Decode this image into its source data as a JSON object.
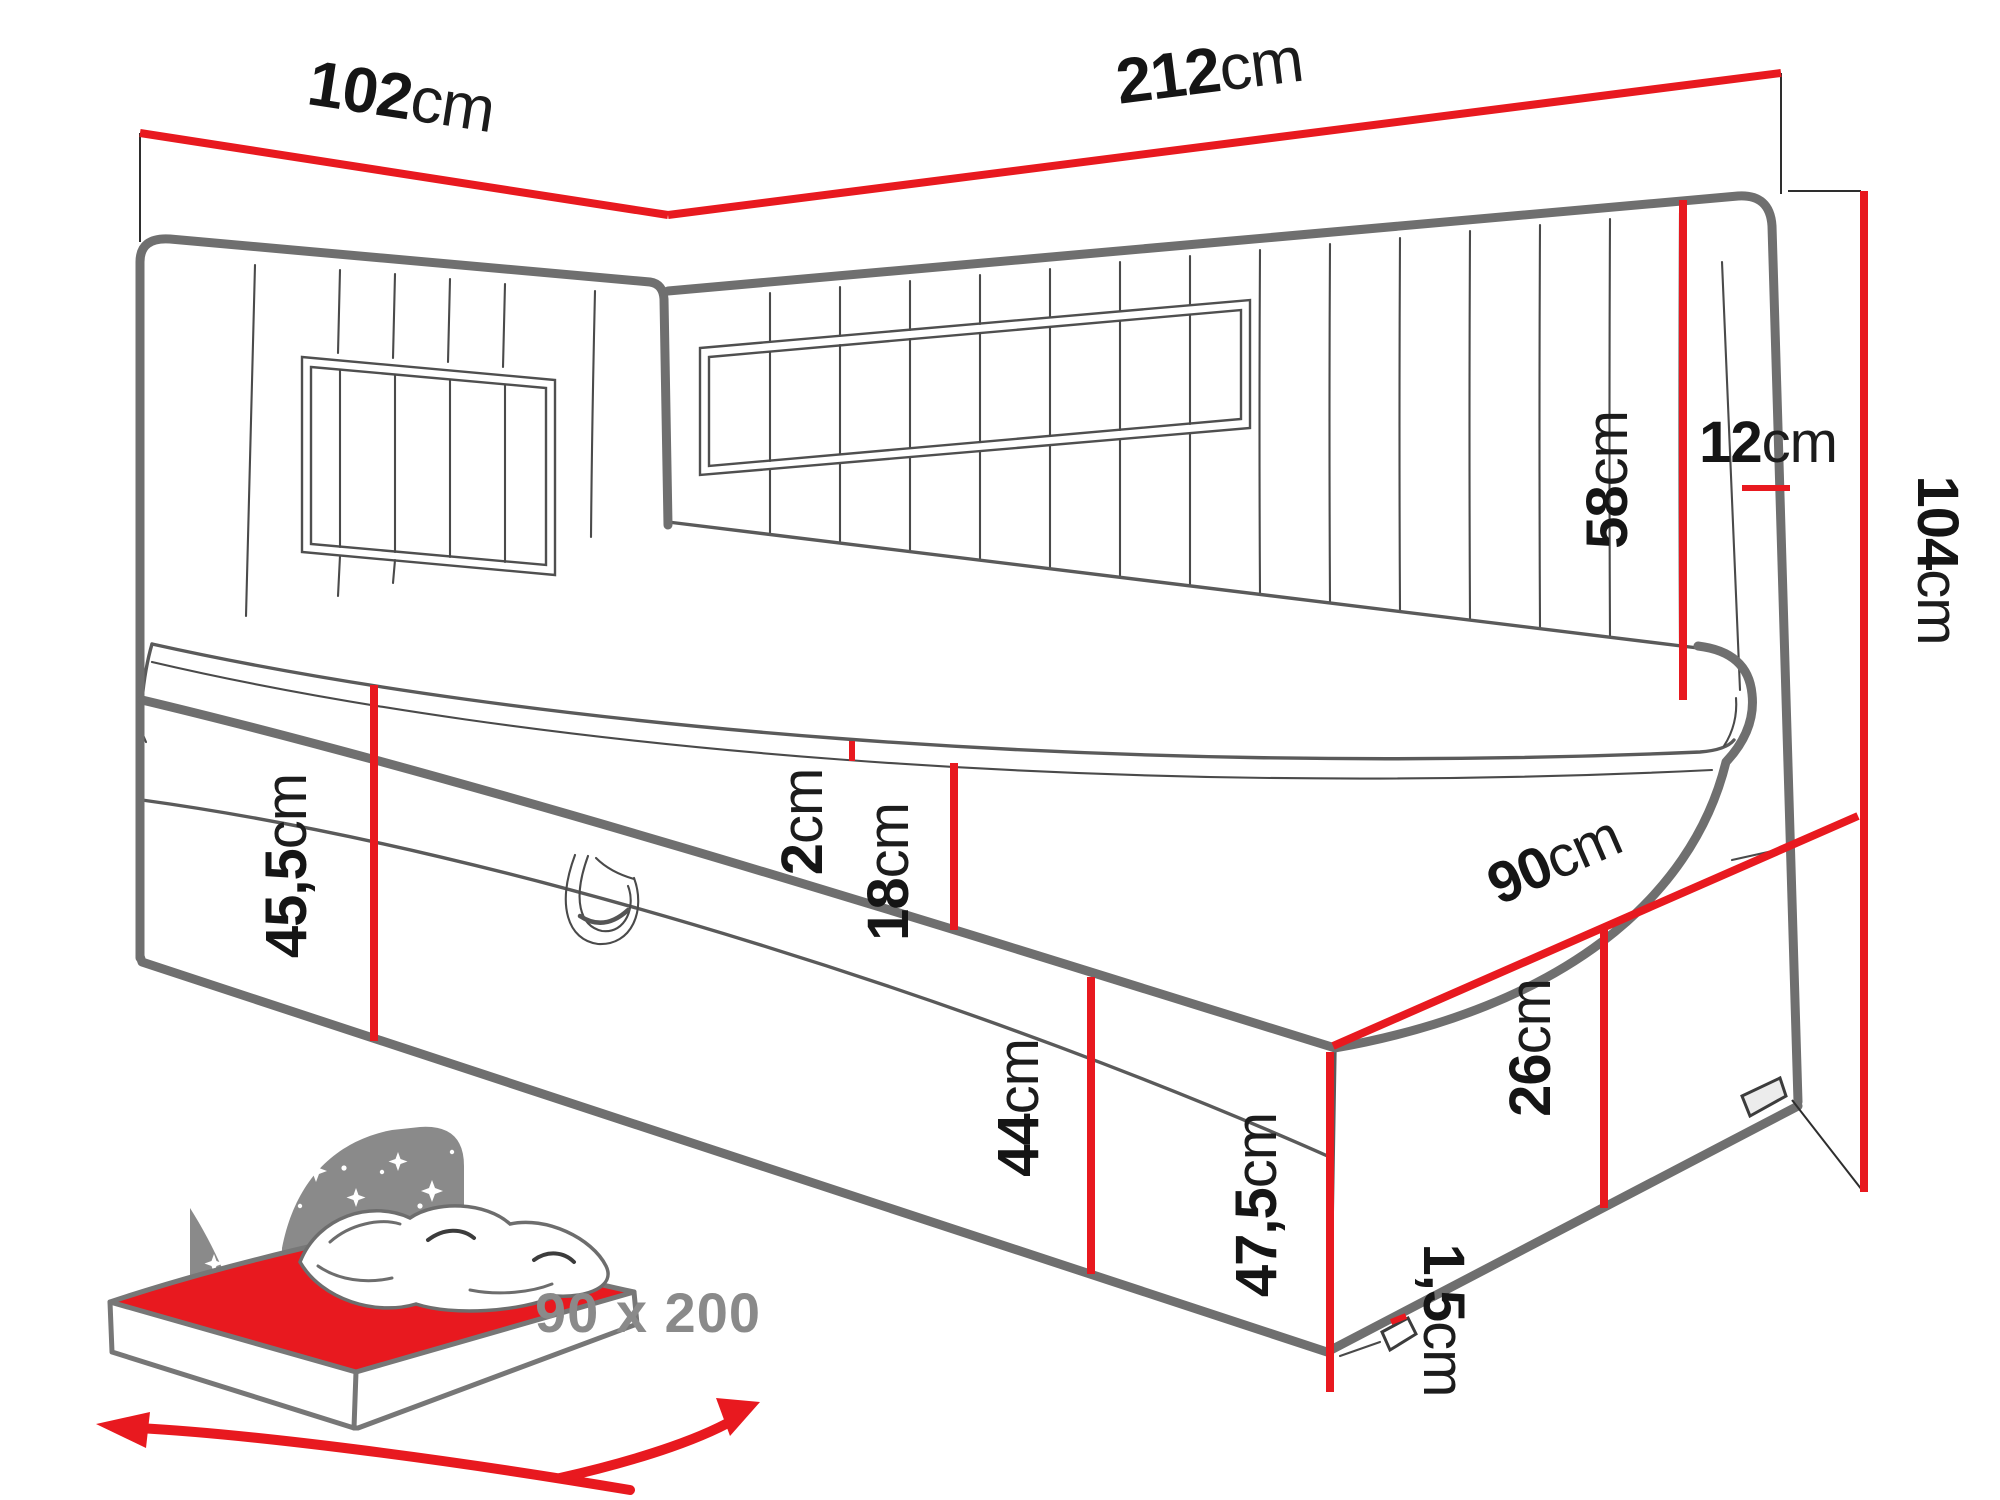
{
  "diagram": {
    "type": "furniture-dimension-drawing",
    "subject": "corner daybed with upholstered headboards and storage base",
    "accent_color": "#e8191f",
    "outline_color": "#6f6f6f",
    "text_color": "#151515",
    "icon_color": "#8a8a8a"
  },
  "dims": {
    "d102": {
      "num": "102",
      "unit": "cm",
      "meaning": "headboard side width"
    },
    "d212": {
      "num": "212",
      "unit": "cm",
      "meaning": "total length"
    },
    "d12": {
      "num": "12",
      "unit": "cm",
      "meaning": "headboard thickness"
    },
    "d58": {
      "num": "58",
      "unit": "cm",
      "meaning": "headboard height above mattress"
    },
    "d104": {
      "num": "104",
      "unit": "cm",
      "meaning": "total height"
    },
    "d2": {
      "num": "2",
      "unit": "cm",
      "meaning": "topper thickness"
    },
    "d18": {
      "num": "18",
      "unit": "cm",
      "meaning": "mattress thickness"
    },
    "d455": {
      "num": "45,5",
      "unit": "cm",
      "meaning": "height to sleeping surface"
    },
    "d44": {
      "num": "44",
      "unit": "cm",
      "meaning": "base height"
    },
    "d475": {
      "num": "47,5",
      "unit": "cm",
      "meaning": "height at front corner"
    },
    "d90": {
      "num": "90",
      "unit": "cm",
      "meaning": "depth"
    },
    "d26": {
      "num": "26",
      "unit": "cm",
      "meaning": "storage drawer height"
    },
    "d15": {
      "num": "1,5",
      "unit": "cm",
      "meaning": "leg height"
    }
  },
  "badge": {
    "label": "90 x 200",
    "meaning": "mattress size in cm"
  }
}
